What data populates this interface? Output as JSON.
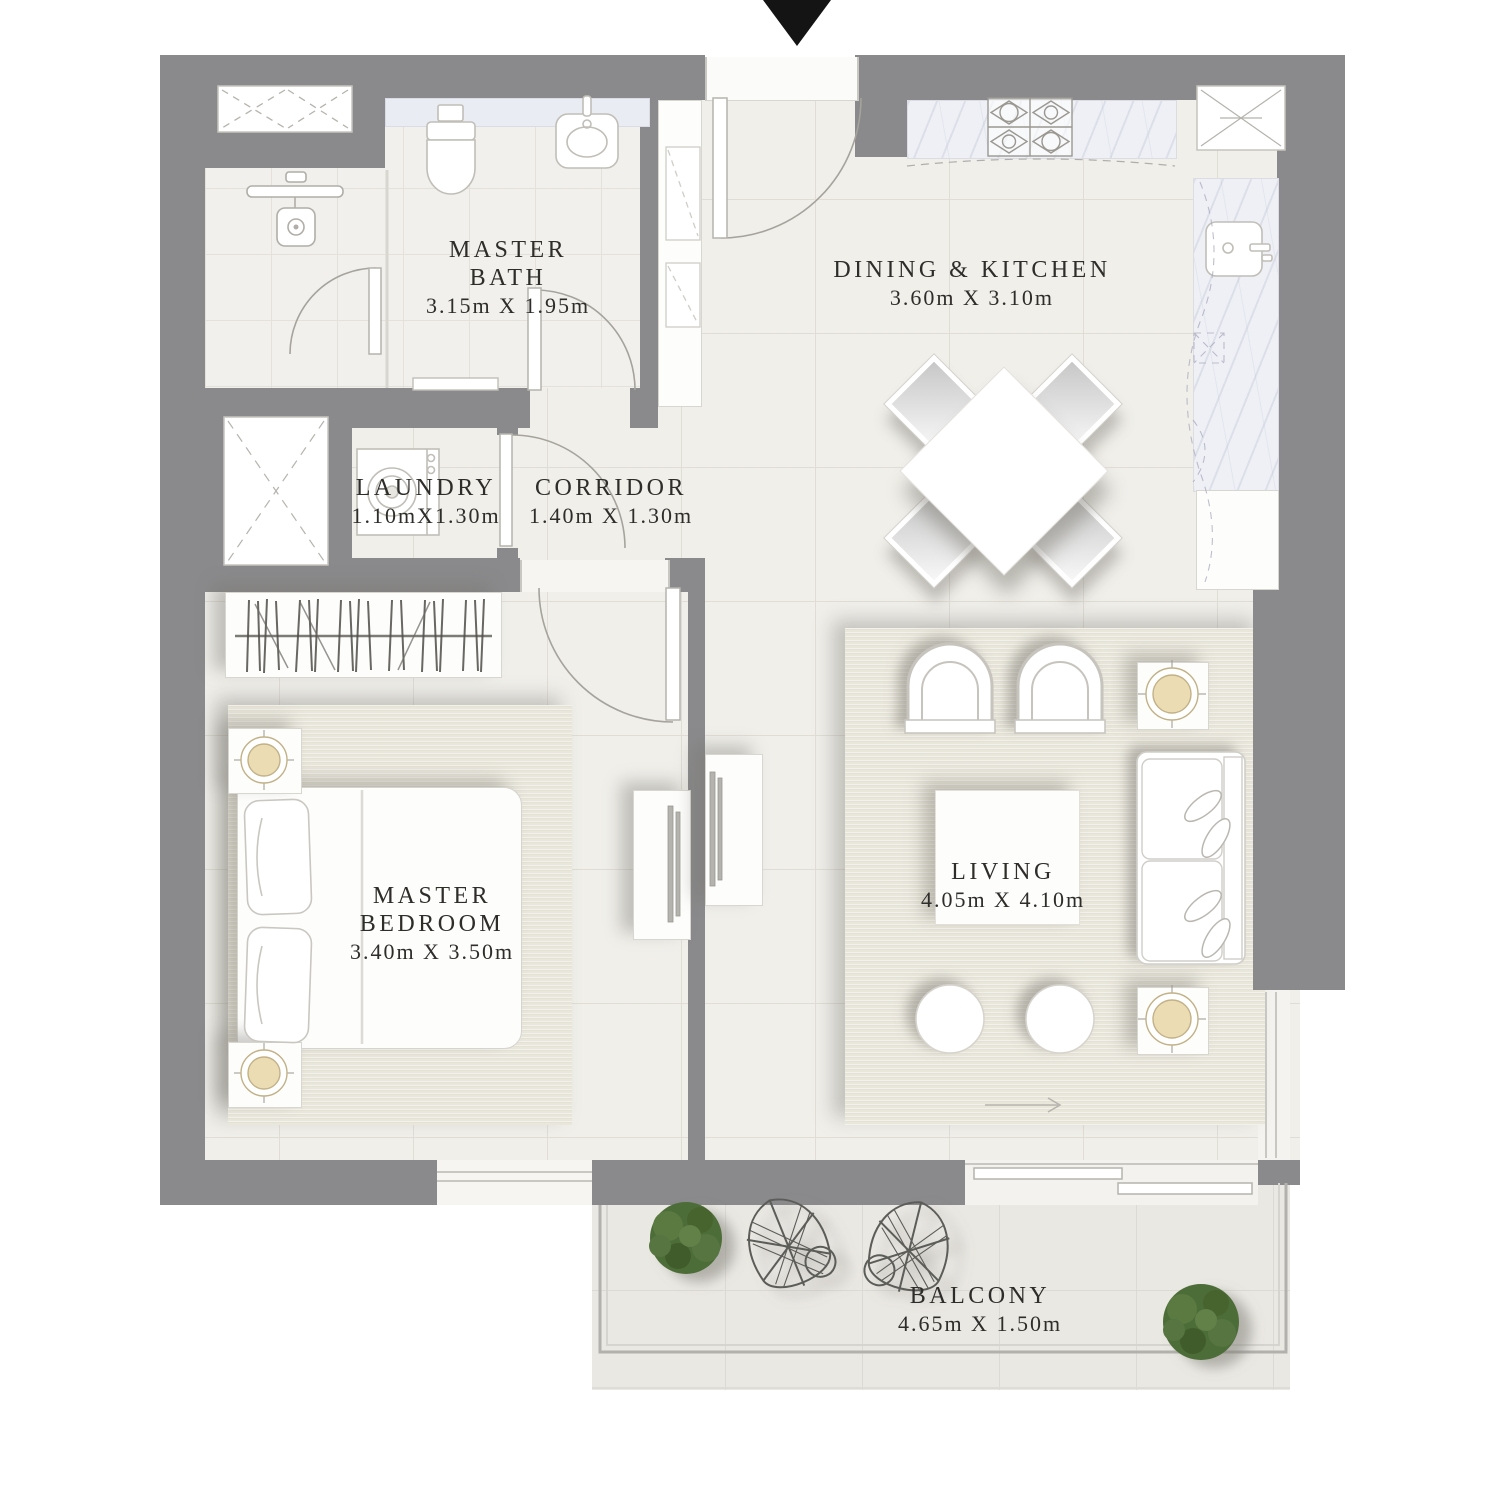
{
  "plan": {
    "title": "apartment-floor-plan",
    "rooms": {
      "master_bath": {
        "line1": "MASTER",
        "line2": "BATH",
        "dims": "3.15m X 1.95m"
      },
      "dining_kitchen": {
        "line1": "DINING & KITCHEN",
        "dims": "3.60m X 3.10m"
      },
      "laundry": {
        "line1": "LAUNDRY",
        "dims": "1.10mX1.30m"
      },
      "corridor": {
        "line1": "CORRIDOR",
        "dims": "1.40m X 1.30m"
      },
      "master_bedroom": {
        "line1": "MASTER",
        "line2": "BEDROOM",
        "dims": "3.40m X 3.50m"
      },
      "living": {
        "line1": "LIVING",
        "dims": "4.05m X 4.10m"
      },
      "balcony": {
        "line1": "BALCONY",
        "dims": "4.65m X 1.50m"
      }
    },
    "icons": {
      "entrance_arrow": "down-triangle"
    }
  },
  "colors": {
    "wall": "#8a8a8c",
    "floor": "#f0efea",
    "balcony_floor": "#eae8e3",
    "rug": "#e9e6da",
    "marble": "#eef0f6",
    "plant_green": "#4e6d38",
    "label_text": "#2e2d2a",
    "arrow_black": "#141414"
  }
}
